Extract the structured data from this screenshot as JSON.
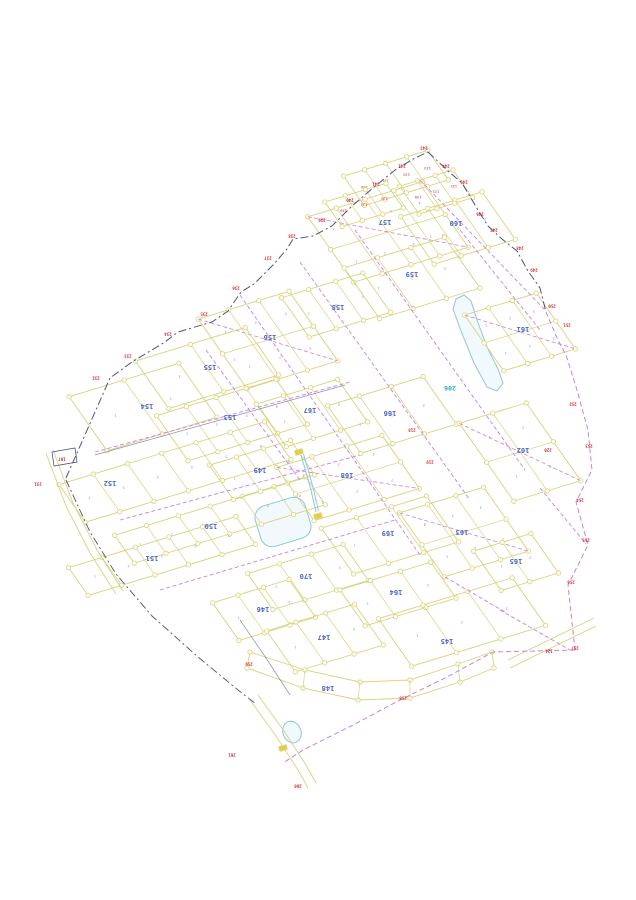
{
  "meta": {
    "type": "cadastral-parcel-map"
  },
  "map": {
    "width": 636,
    "height": 900,
    "colors": {
      "parcel": "#d8d37c",
      "node_fill": "#fffdf2",
      "magenta": "#cf7fd6",
      "navy": "#4a5382",
      "dark": "#5a5f8a",
      "block_label": "#4a66c8",
      "lot_number": "#8090c8",
      "red": "#cc2a2a",
      "water_stroke": "#8fc6de",
      "water_fill": "#f2f9fc",
      "water_label": "#2fa8c8",
      "yellow_marker": "#e3cf4e"
    },
    "grid_axes": {
      "u": [
        0.956,
        -0.292
      ],
      "v": [
        0.574,
        0.819
      ]
    },
    "blocks": [
      {
        "label": "156",
        "cx": 268,
        "cy": 340,
        "du": 95,
        "dv": 85,
        "lots": 3,
        "grid": true,
        "lx": 270,
        "ly": 337
      },
      {
        "label": "157",
        "cx": 388,
        "cy": 232,
        "du": 120,
        "dv": 80,
        "lots": 4,
        "grid": true,
        "lx": 385,
        "ly": 222
      },
      {
        "label": "158",
        "cx": 336,
        "cy": 305,
        "du": 85,
        "dv": 48,
        "lots": 3,
        "lx": 338,
        "ly": 307
      },
      {
        "label": "159",
        "cx": 412,
        "cy": 278,
        "du": 105,
        "dv": 62,
        "lots": 3,
        "lx": 412,
        "ly": 274
      },
      {
        "label": "160",
        "cx": 458,
        "cy": 228,
        "du": 85,
        "dv": 58,
        "lots": 3,
        "lx": 456,
        "ly": 223
      },
      {
        "label": "161",
        "cx": 520,
        "cy": 332,
        "du": 75,
        "dv": 68,
        "lots": 3,
        "grid": true,
        "lx": 523,
        "ly": 329
      },
      {
        "label": "155",
        "cx": 207,
        "cy": 368,
        "du": 115,
        "dv": 58,
        "lots": 2,
        "lx": 210,
        "ly": 367
      },
      {
        "label": "154",
        "cx": 143,
        "cy": 407,
        "du": 115,
        "dv": 66,
        "lots": 2,
        "lx": 147,
        "ly": 406
      },
      {
        "label": "153",
        "cx": 232,
        "cy": 420,
        "du": 125,
        "dv": 55,
        "lots": 4,
        "lx": 230,
        "ly": 417
      },
      {
        "label": "152",
        "cx": 175,
        "cy": 472,
        "du": 215,
        "dv": 46,
        "lots": 6,
        "lx": 110,
        "ly": 483
      },
      {
        "label": "150",
        "cx": 220,
        "cy": 520,
        "du": 200,
        "dv": 34,
        "lots": 6,
        "lx": 211,
        "ly": 526
      },
      {
        "label": "151",
        "cx": 162,
        "cy": 556,
        "du": 175,
        "dv": 34,
        "lots": 5,
        "lx": 152,
        "ly": 558
      },
      {
        "label": "149",
        "cx": 262,
        "cy": 470,
        "du": 85,
        "dv": 42,
        "lots": 3,
        "lx": 260,
        "ly": 470
      },
      {
        "label": "167",
        "cx": 312,
        "cy": 413,
        "du": 85,
        "dv": 52,
        "lots": 3,
        "lx": 310,
        "ly": 410
      },
      {
        "label": "166",
        "cx": 392,
        "cy": 415,
        "du": 100,
        "dv": 58,
        "lots": 3,
        "lx": 390,
        "ly": 413
      },
      {
        "label": "168",
        "cx": 348,
        "cy": 478,
        "du": 110,
        "dv": 65,
        "lots": 3,
        "grid": true,
        "lx": 347,
        "ly": 475
      },
      {
        "label": "169",
        "cx": 390,
        "cy": 535,
        "du": 110,
        "dv": 56,
        "lots": 3,
        "lx": 388,
        "ly": 533
      },
      {
        "label": "170",
        "cx": 308,
        "cy": 577,
        "du": 100,
        "dv": 44,
        "lots": 3,
        "lx": 306,
        "ly": 576
      },
      {
        "label": "162",
        "cx": 520,
        "cy": 452,
        "du": 70,
        "dv": 95,
        "lots": 2,
        "grid": true,
        "lx": 523,
        "ly": 450
      },
      {
        "label": "163",
        "cx": 464,
        "cy": 532,
        "du": 88,
        "dv": 78,
        "lots": 3,
        "grid": true,
        "lx": 462,
        "ly": 532
      },
      {
        "label": "165",
        "cx": 516,
        "cy": 562,
        "du": 60,
        "dv": 48,
        "lots": 2,
        "lx": 516,
        "ly": 561
      },
      {
        "label": "164",
        "cx": 398,
        "cy": 594,
        "du": 95,
        "dv": 44,
        "lots": 3,
        "lx": 396,
        "ly": 592
      },
      {
        "label": "146",
        "cx": 264,
        "cy": 610,
        "du": 80,
        "dv": 46,
        "lots": 3,
        "lx": 263,
        "ly": 609
      },
      {
        "label": "147",
        "cx": 325,
        "cy": 638,
        "du": 92,
        "dv": 50,
        "lots": 3,
        "lx": 324,
        "ly": 637
      },
      {
        "label": "145",
        "cx": 462,
        "cy": 622,
        "du": 140,
        "dv": 58,
        "lots": 3,
        "lx": 447,
        "ly": 641
      },
      {
        "label": "",
        "cx": 396,
        "cy": 178,
        "du": 88,
        "dv": 36,
        "lots": 4,
        "redLots": true
      },
      {
        "label": "",
        "cx": 436,
        "cy": 192,
        "du": 56,
        "dv": 34,
        "lots": 3,
        "redLots": true
      },
      {
        "label": "",
        "cx": 364,
        "cy": 205,
        "du": 64,
        "dv": 30,
        "lots": 3,
        "redLots": true
      }
    ],
    "band_block": {
      "label": "148",
      "lx": 328,
      "ly": 688,
      "top": [
        [
          250,
          652
        ],
        [
          305,
          670
        ],
        [
          360,
          682
        ],
        [
          410,
          680
        ],
        [
          458,
          664
        ],
        [
          492,
          652
        ]
      ],
      "bottom": [
        [
          494,
          668
        ],
        [
          460,
          682
        ],
        [
          410,
          698
        ],
        [
          358,
          700
        ],
        [
          303,
          688
        ],
        [
          247,
          668
        ]
      ]
    },
    "boundary_navy_nw": [
      [
        66,
        478
      ],
      [
        110,
        378
      ],
      [
        132,
        362
      ],
      [
        165,
        342
      ],
      [
        178,
        332
      ],
      [
        212,
        322
      ],
      [
        228,
        311
      ],
      [
        241,
        292
      ],
      [
        254,
        284
      ],
      [
        274,
        264
      ],
      [
        287,
        249
      ],
      [
        293,
        239
      ],
      [
        313,
        236
      ],
      [
        332,
        226
      ],
      [
        352,
        206
      ],
      [
        373,
        188
      ],
      [
        395,
        170
      ],
      [
        415,
        158
      ],
      [
        428,
        152
      ]
    ],
    "boundary_navy_ne": [
      [
        428,
        152
      ],
      [
        447,
        170
      ],
      [
        462,
        183
      ],
      [
        478,
        210
      ],
      [
        488,
        226
      ],
      [
        502,
        239
      ],
      [
        517,
        251
      ],
      [
        528,
        271
      ],
      [
        540,
        288
      ],
      [
        546,
        312
      ]
    ],
    "boundary_dark_sw": [
      [
        66,
        480
      ],
      [
        90,
        532
      ],
      [
        116,
        574
      ],
      [
        152,
        616
      ],
      [
        198,
        657
      ],
      [
        238,
        690
      ],
      [
        256,
        704
      ]
    ],
    "boundary_magenta_right": [
      [
        546,
        312
      ],
      [
        557,
        338
      ],
      [
        566,
        355
      ],
      [
        577,
        390
      ],
      [
        588,
        430
      ],
      [
        592,
        470
      ],
      [
        576,
        502
      ],
      [
        588,
        545
      ],
      [
        568,
        585
      ],
      [
        575,
        650
      ]
    ],
    "boundary_magenta_bottom": [
      [
        575,
        650
      ],
      [
        493,
        652
      ],
      [
        447,
        677
      ],
      [
        400,
        700
      ],
      [
        353,
        725
      ],
      [
        303,
        750
      ],
      [
        283,
        763
      ]
    ],
    "dashed_streets": [
      [
        [
          95,
          452
        ],
        [
          350,
          382
        ]
      ],
      [
        [
          120,
          520
        ],
        [
          360,
          455
        ]
      ],
      [
        [
          160,
          590
        ],
        [
          395,
          520
        ]
      ],
      [
        [
          240,
          295
        ],
        [
          420,
          555
        ]
      ],
      [
        [
          300,
          262
        ],
        [
          470,
          500
        ]
      ],
      [
        [
          355,
          230
        ],
        [
          525,
          470
        ]
      ],
      [
        [
          420,
          180
        ],
        [
          545,
          310
        ]
      ],
      [
        [
          206,
          350
        ],
        [
          300,
          480
        ]
      ],
      [
        [
          460,
          230
        ],
        [
          540,
          330
        ]
      ],
      [
        [
          540,
          488
        ],
        [
          586,
          544
        ]
      ],
      [
        [
          445,
          577
        ],
        [
          505,
          612
        ]
      ],
      [
        [
          500,
          610
        ],
        [
          570,
          650
        ]
      ]
    ],
    "dark_streets": [
      [
        [
          95,
          455
        ],
        [
          345,
          385
        ]
      ],
      [
        [
          240,
          620
        ],
        [
          266,
          658
        ],
        [
          290,
          695
        ]
      ]
    ],
    "roads": [
      {
        "a": [
          [
            46,
            453
          ],
          [
            66,
            506
          ],
          [
            90,
            553
          ],
          [
            116,
            594
          ]
        ],
        "b": [
          [
            53,
            450
          ],
          [
            73,
            503
          ],
          [
            97,
            550
          ],
          [
            123,
            591
          ]
        ]
      },
      {
        "a": [
          [
            250,
            700
          ],
          [
            276,
            736
          ],
          [
            298,
            770
          ],
          [
            308,
            788
          ]
        ],
        "b": [
          [
            258,
            695
          ],
          [
            284,
            731
          ],
          [
            306,
            765
          ],
          [
            316,
            783
          ]
        ]
      },
      {
        "a": [
          [
            510,
            668
          ],
          [
            596,
            626
          ]
        ],
        "b": [
          [
            508,
            660
          ],
          [
            594,
            618
          ]
        ]
      }
    ],
    "water_poly": [
      [
        456,
        299
      ],
      [
        464,
        295
      ],
      [
        471,
        301
      ],
      [
        477,
        320
      ],
      [
        487,
        347
      ],
      [
        498,
        369
      ],
      [
        503,
        383
      ],
      [
        497,
        391
      ],
      [
        487,
        387
      ],
      [
        474,
        363
      ],
      [
        461,
        331
      ],
      [
        453,
        309
      ]
    ],
    "water_rect": {
      "cx": 283,
      "cy": 522,
      "w": 52,
      "h": 42,
      "rx": 12,
      "angle": -17
    },
    "water_blob": {
      "cx": 292,
      "cy": 732,
      "rx": 9,
      "ry": 11,
      "angle": -20
    },
    "stream": [
      [
        301,
        455
      ],
      [
        306,
        472
      ],
      [
        311,
        490
      ],
      [
        316,
        512
      ]
    ],
    "water_label": {
      "text": "206",
      "x": 450,
      "y": 388
    },
    "survey_rect": [
      [
        52,
        452
      ],
      [
        75,
        448
      ],
      [
        77,
        462
      ],
      [
        54,
        466
      ]
    ],
    "yellow_markers": [
      [
        299,
        452
      ],
      [
        318,
        516
      ],
      [
        283,
        748
      ]
    ],
    "red_markers": [
      [
        38,
        484,
        "231"
      ],
      [
        96,
        378,
        "232"
      ],
      [
        128,
        356,
        "233"
      ],
      [
        168,
        334,
        "234"
      ],
      [
        204,
        314,
        "235"
      ],
      [
        236,
        288,
        "236"
      ],
      [
        268,
        258,
        "237"
      ],
      [
        292,
        236,
        "238"
      ],
      [
        322,
        220,
        "239"
      ],
      [
        350,
        200,
        "240"
      ],
      [
        376,
        184,
        "241"
      ],
      [
        402,
        166,
        "242"
      ],
      [
        424,
        148,
        "243"
      ],
      [
        446,
        166,
        "244"
      ],
      [
        464,
        182,
        "245"
      ],
      [
        480,
        214,
        "246"
      ],
      [
        494,
        230,
        "247"
      ],
      [
        520,
        248,
        "248"
      ],
      [
        534,
        270,
        "249"
      ],
      [
        552,
        306,
        "250"
      ],
      [
        567,
        325,
        "251"
      ],
      [
        573,
        404,
        "252"
      ],
      [
        589,
        446,
        "253"
      ],
      [
        580,
        500,
        "254"
      ],
      [
        586,
        540,
        "255"
      ],
      [
        571,
        582,
        "256"
      ],
      [
        575,
        648,
        "257"
      ],
      [
        549,
        651,
        "124"
      ],
      [
        403,
        698,
        "258"
      ],
      [
        249,
        664,
        "259"
      ],
      [
        412,
        430,
        "218"
      ],
      [
        430,
        462,
        "219"
      ],
      [
        548,
        450,
        "220"
      ],
      [
        62,
        459,
        "107"
      ],
      [
        298,
        786,
        "260"
      ],
      [
        232,
        755,
        "261"
      ]
    ],
    "red_lot_values": [
      "130",
      "131",
      "132",
      "133",
      "134",
      "135",
      "136",
      "137",
      "138",
      "139"
    ]
  }
}
